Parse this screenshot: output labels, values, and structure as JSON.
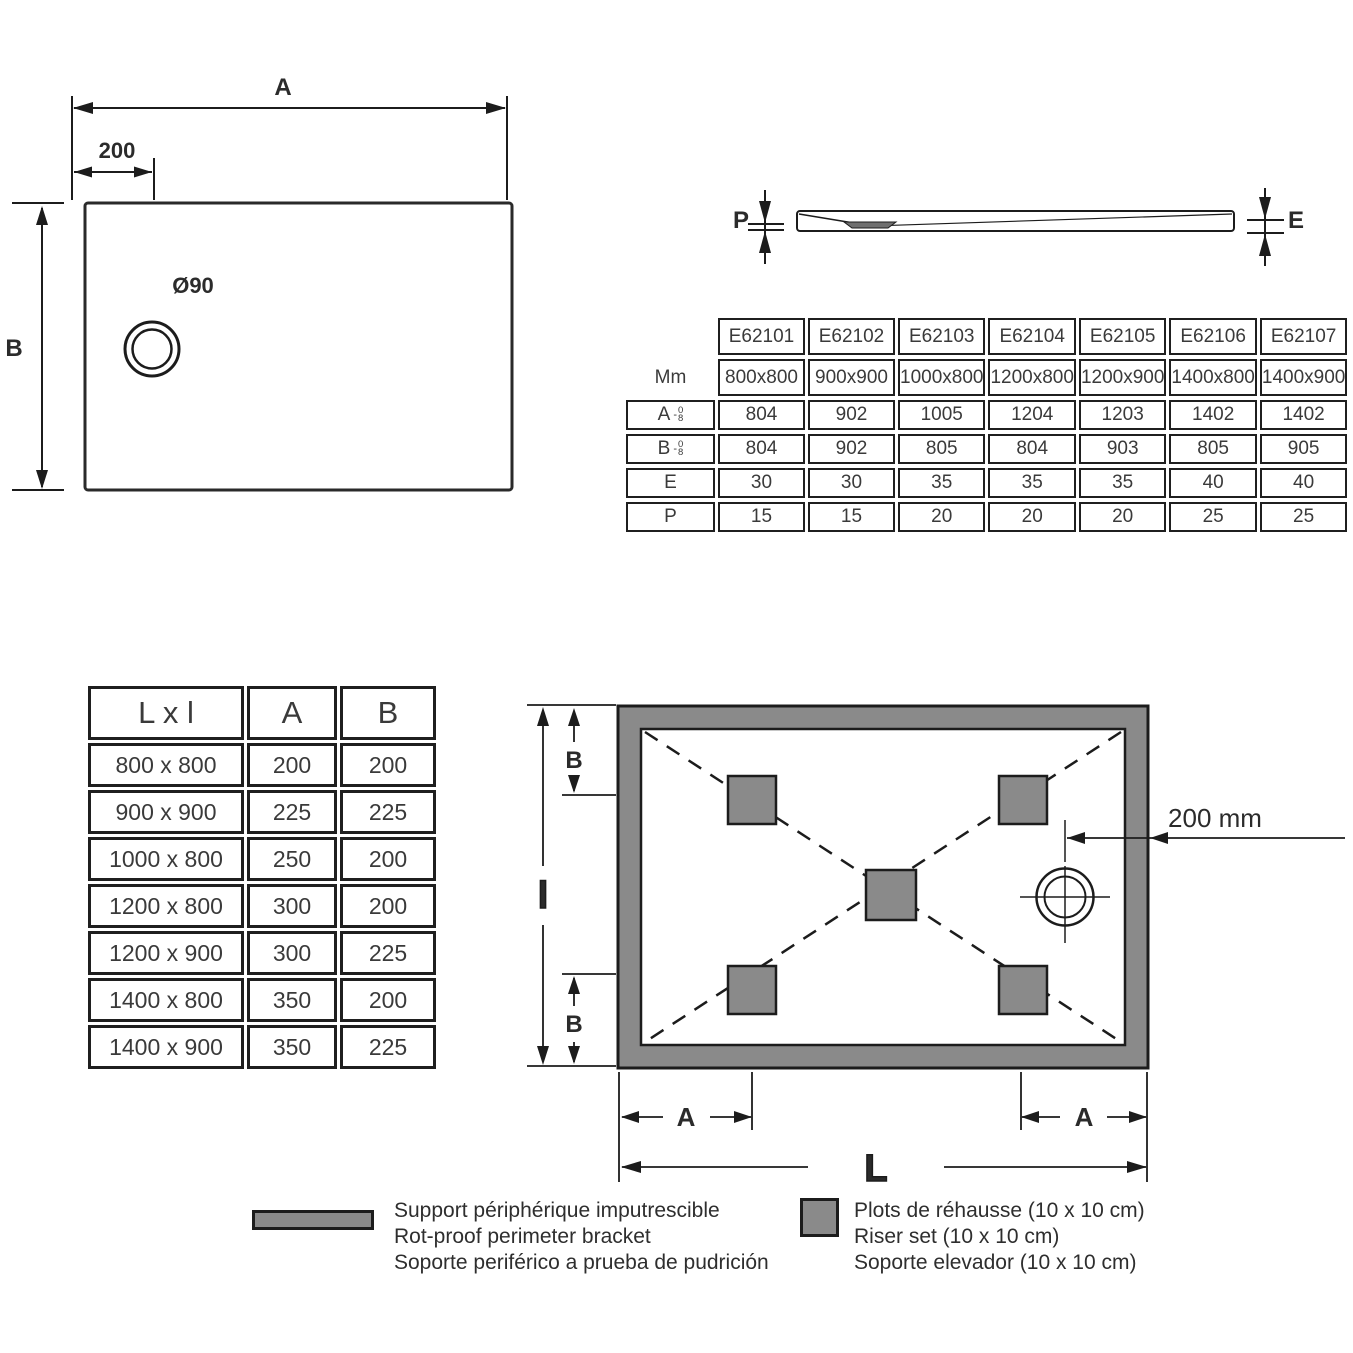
{
  "top_view": {
    "label_a": "A",
    "offset": "200",
    "label_b": "B",
    "drain_diameter": "Ø90"
  },
  "profile_view": {
    "label_p": "P",
    "label_e": "E"
  },
  "spec_table": {
    "row_mm_label": "Mm",
    "row_a_label": "A",
    "row_b_label": "B",
    "row_e_label": "E",
    "row_p_label": "P",
    "tol_dash": "-",
    "tol_top": "0",
    "tol_bottom": "8",
    "codes": [
      "E62101",
      "E62102",
      "E62103",
      "E62104",
      "E62105",
      "E62106",
      "E62107"
    ],
    "mm": [
      "800x800",
      "900x900",
      "1000x800",
      "1200x800",
      "1200x900",
      "1400x800",
      "1400x900"
    ],
    "a": [
      "804",
      "902",
      "1005",
      "1204",
      "1203",
      "1402",
      "1402"
    ],
    "b": [
      "804",
      "902",
      "805",
      "804",
      "903",
      "805",
      "905"
    ],
    "e": [
      "30",
      "30",
      "35",
      "35",
      "35",
      "40",
      "40"
    ],
    "p": [
      "15",
      "15",
      "20",
      "20",
      "20",
      "25",
      "25"
    ]
  },
  "size_table": {
    "headers": [
      "L x l",
      "A",
      "B"
    ],
    "rows": [
      [
        "800 x 800",
        "200",
        "200"
      ],
      [
        "900 x 900",
        "225",
        "225"
      ],
      [
        "1000 x 800",
        "250",
        "200"
      ],
      [
        "1200 x 800",
        "300",
        "200"
      ],
      [
        "1200 x 900",
        "300",
        "225"
      ],
      [
        "1400 x 800",
        "350",
        "200"
      ],
      [
        "1400 x 900",
        "350",
        "225"
      ]
    ]
  },
  "plan_view": {
    "label_b_top": "B",
    "label_l_side": "l",
    "label_b_bottom": "B",
    "drain_offset": "200 mm",
    "label_a_left": "A",
    "label_a_right": "A",
    "label_length": "L"
  },
  "legend": {
    "perimeter_lines": [
      "Support périphérique imputrescible",
      "Rot-proof perimeter bracket",
      "Soporte periférico a prueba de pudrición"
    ],
    "riser_lines": [
      "Plots de réhausse (10 x 10 cm)",
      "Riser set (10 x 10 cm)",
      "Soporte elevador (10 x 10 cm)"
    ]
  },
  "colors": {
    "gray_fill": "#8a8a8a",
    "line": "#1c1c1c"
  }
}
